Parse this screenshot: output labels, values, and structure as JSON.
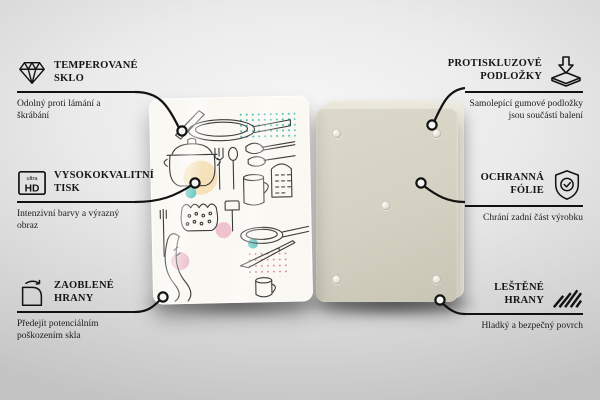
{
  "features": {
    "left": [
      {
        "icon": "diamond-icon",
        "title": "TEMPEROVANÉ SKLO",
        "subtitle": "Odolný proti lámání a škrábání"
      },
      {
        "icon": "ultra-hd-icon",
        "title": "VYSOKOKVALITNÍ TISK",
        "subtitle": "Intenzivní barvy a výrazný obraz"
      },
      {
        "icon": "rounded-corner-icon",
        "title": "ZAOBLENÉ HRANY",
        "subtitle": "Předejít potenciálním poškozením skla"
      }
    ],
    "right": [
      {
        "icon": "anti-slip-pads-icon",
        "title": "PROTISKLUZOVÉ PODLOŽKY",
        "subtitle": "Samolepící gumové podložky jsou součástí balení"
      },
      {
        "icon": "shield-check-icon",
        "title": "OCHRANNÁ FÓLIE",
        "subtitle": "Chrání zadní část výrobku"
      },
      {
        "icon": "polished-edges-icon",
        "title": "LEŠTĚNÉ HRANY",
        "subtitle": "Hladký a bezpečný povrch"
      }
    ]
  },
  "ultra_hd_badge": {
    "line1": "ultra",
    "line2": "HD"
  },
  "back_panel": {
    "pad_count": 5
  },
  "colors": {
    "background_gray": "#d7d7d7",
    "line_black": "#121212",
    "back_panel_beige": "#d4d1c2",
    "print_accent_teal": "#5ec4bd",
    "print_accent_pink": "#eec3ce",
    "print_accent_cream": "#f5e2bb"
  }
}
